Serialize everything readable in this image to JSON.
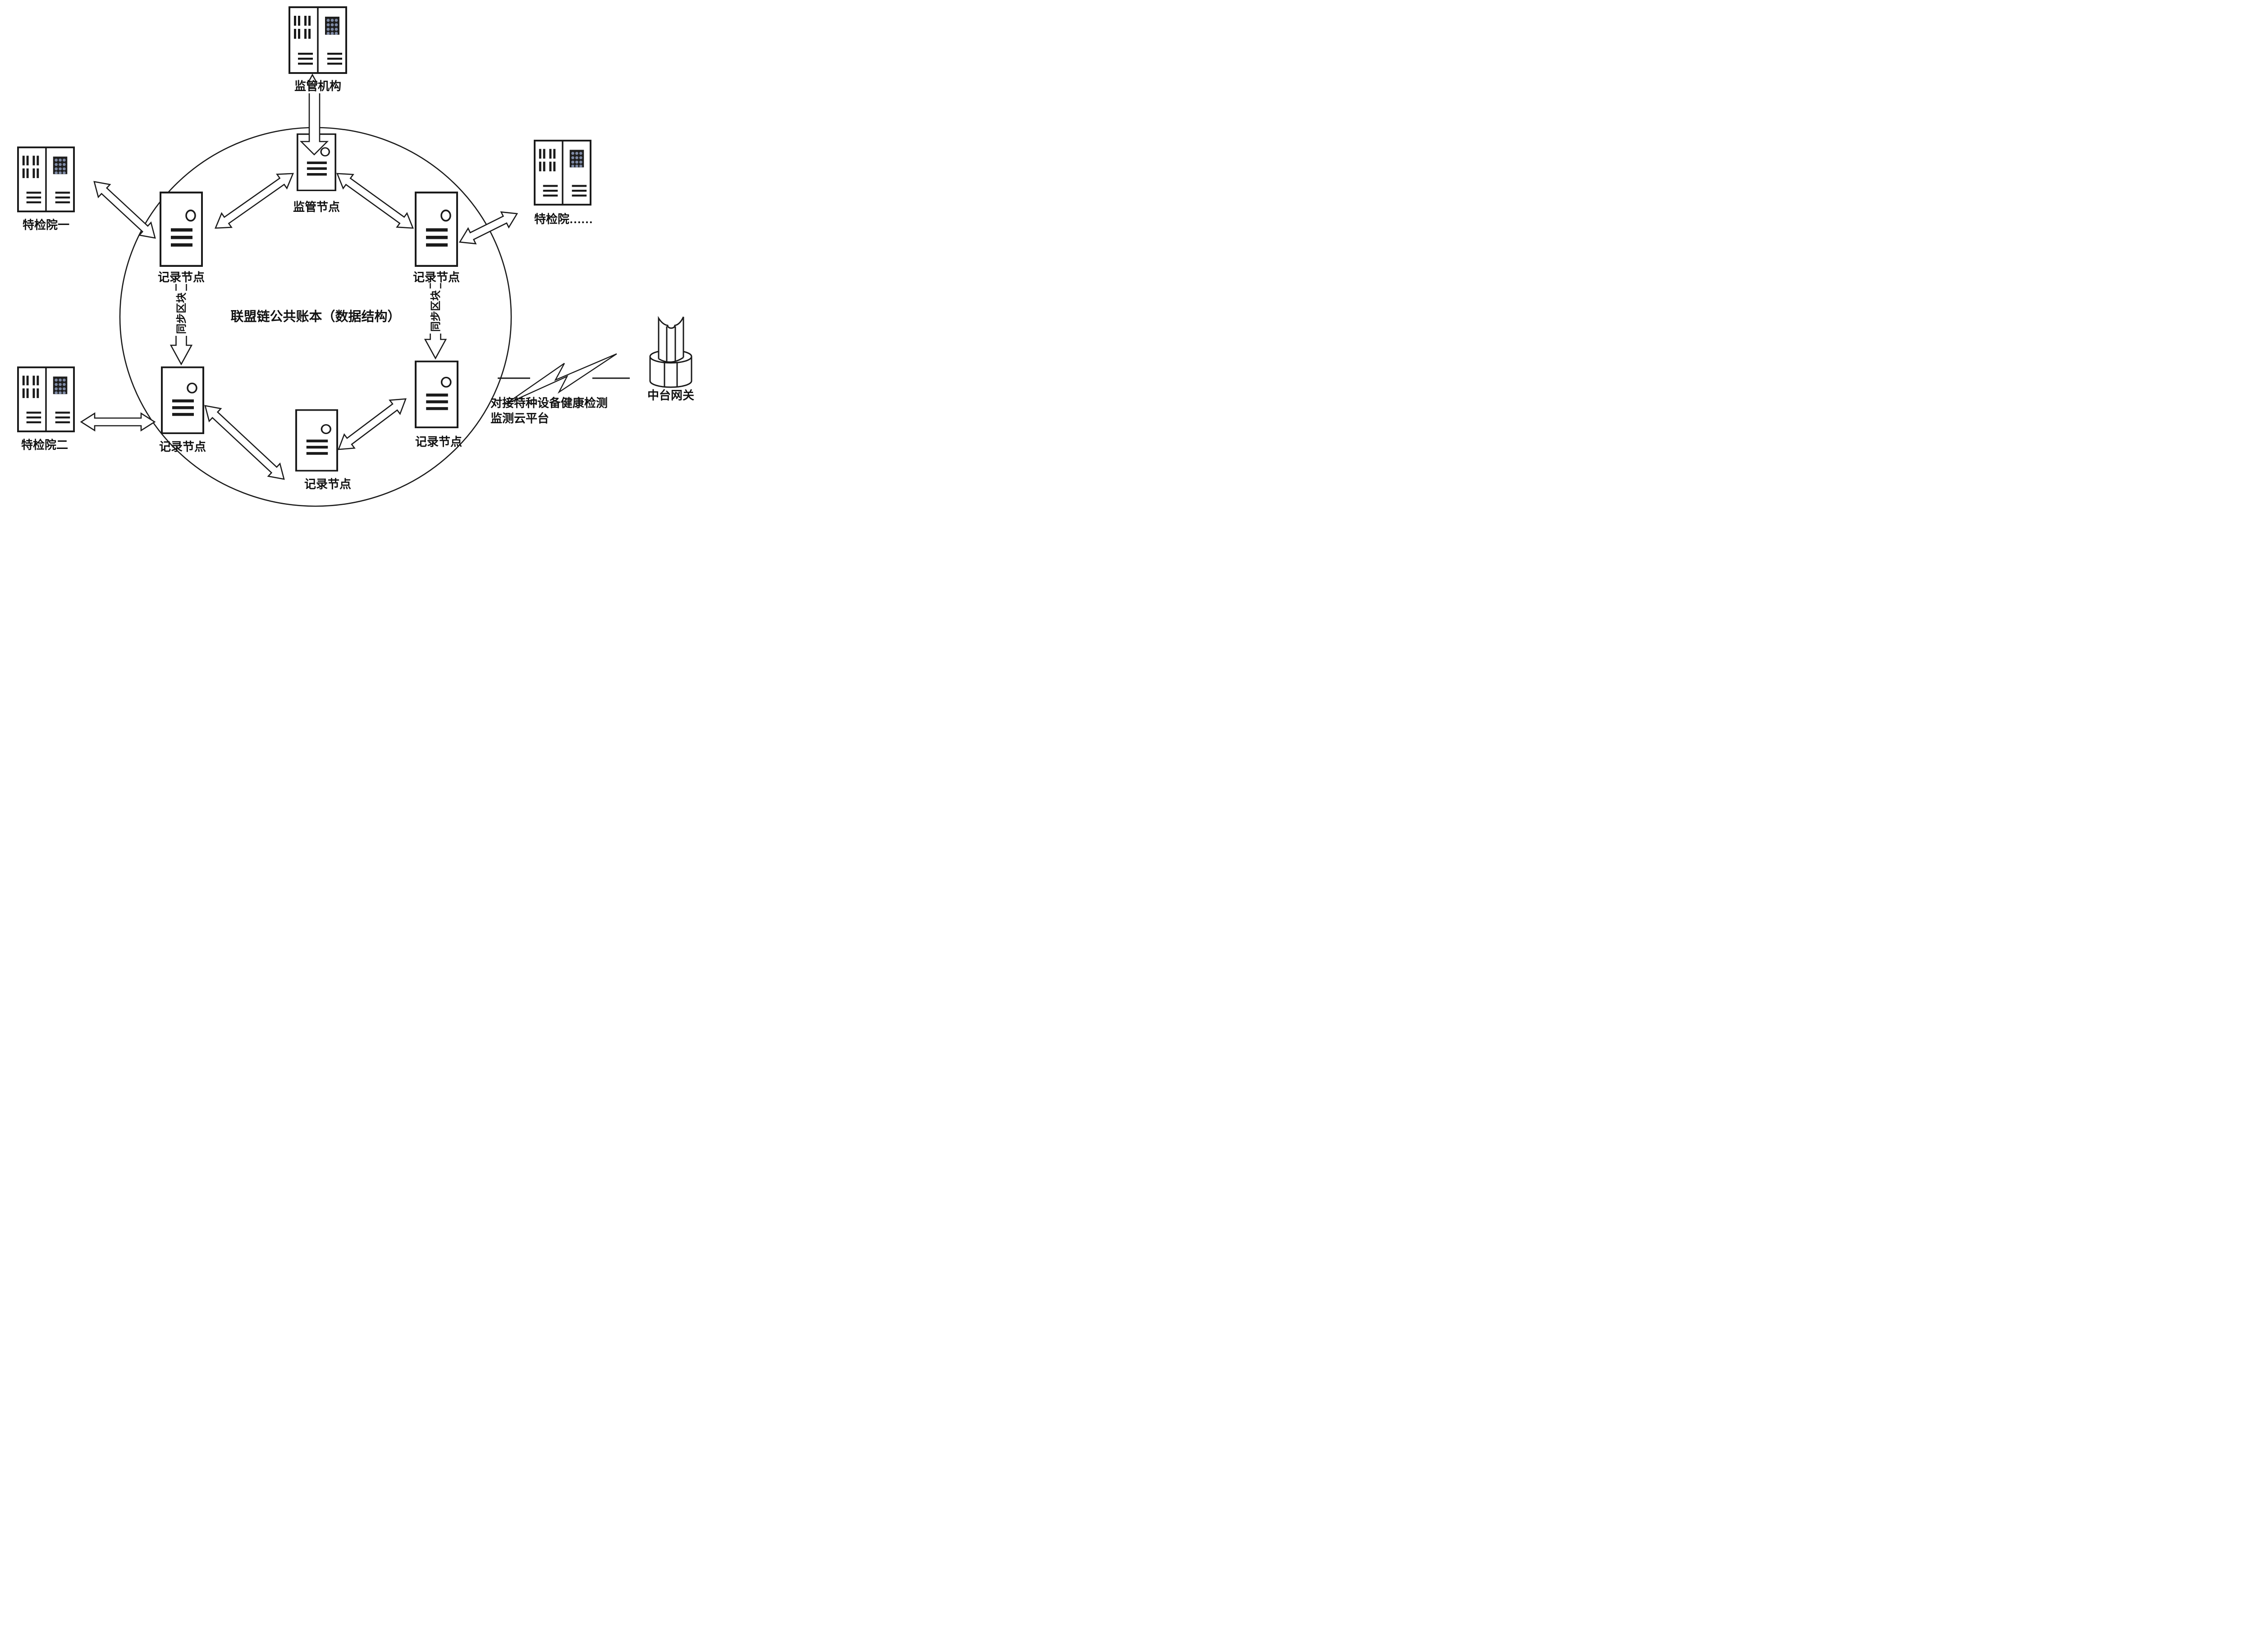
{
  "figure": {
    "background": "#ffffff",
    "stroke_color": "#1a1a1a",
    "keypad_bg": "#1e1e1e",
    "keypad_dot_color": "#7e8aa5",
    "center_label": "联盟链公共账本（数据结构）",
    "regulator_cabinet": {
      "label": "监管机构"
    },
    "supervisory_node": {
      "label": "监管节点"
    },
    "record_node_labels": [
      "记录节点",
      "记录节点",
      "记录节点",
      "记录节点",
      "记录节点"
    ],
    "institute_cabinets": [
      {
        "label": "特检院一"
      },
      {
        "label": "特检院二"
      },
      {
        "label": "特检院……"
      }
    ],
    "sync_block_labels": [
      "同步区块",
      "同步区块"
    ],
    "cloud_annotation": {
      "line1": "对接特种设备健康检测",
      "line2": "监测云平台"
    },
    "gateway": {
      "label": "中台网关"
    }
  }
}
